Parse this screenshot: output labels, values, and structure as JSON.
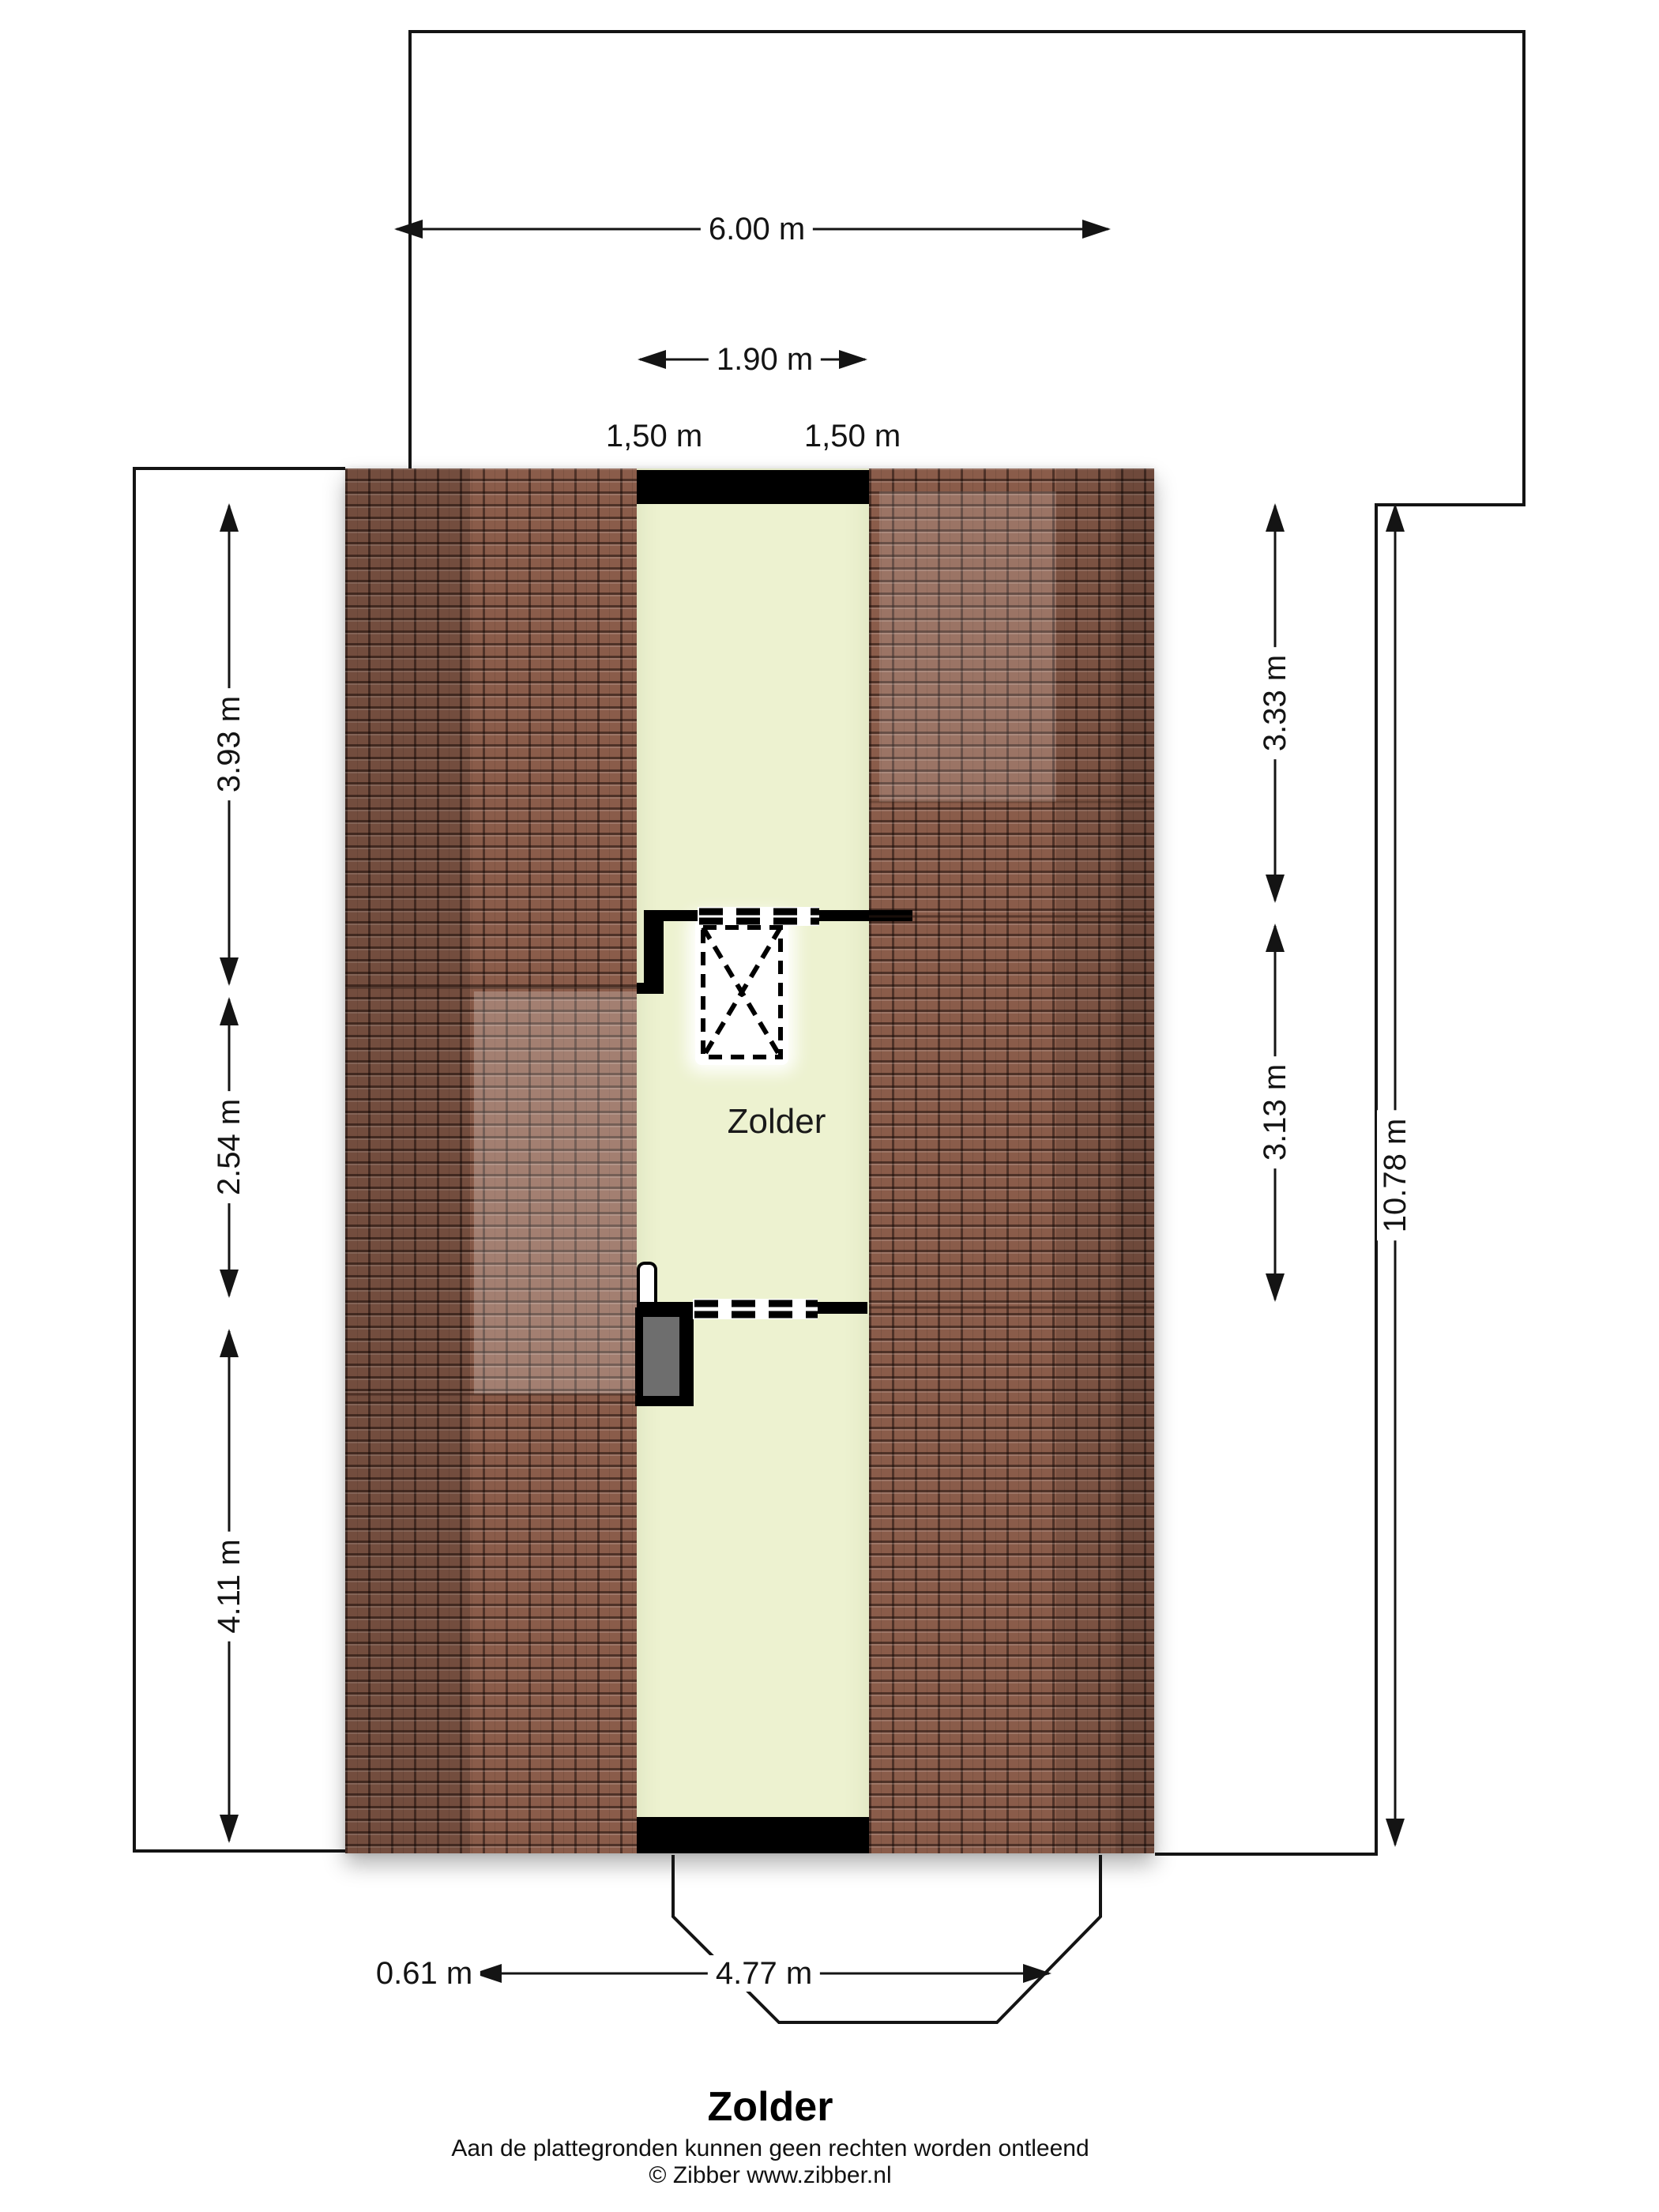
{
  "plan": {
    "room_label": "Zolder",
    "title": "Zolder",
    "disclaimer": "Aan de plattegronden kunnen geen rechten worden ontleend",
    "copyright": "© Zibber www.zibber.nl"
  },
  "dimensions": {
    "top_width": "6.00 m",
    "inner_width": "1.90 m",
    "segment_left": "1,50 m",
    "segment_right": "1,50 m",
    "left_top": "3.93 m",
    "left_middle": "2.54 m",
    "left_bottom": "4.11 m",
    "right_top": "3.33 m",
    "right_middle": "3.13 m",
    "right_total": "10.78 m",
    "bottom_offset": "0.61 m",
    "bottom_width": "4.77 m"
  },
  "colors": {
    "roof": "#8a5c4a",
    "room": "#edf2d0",
    "wall": "#000000",
    "chimney": "#6e6e6e",
    "line": "#141414"
  }
}
